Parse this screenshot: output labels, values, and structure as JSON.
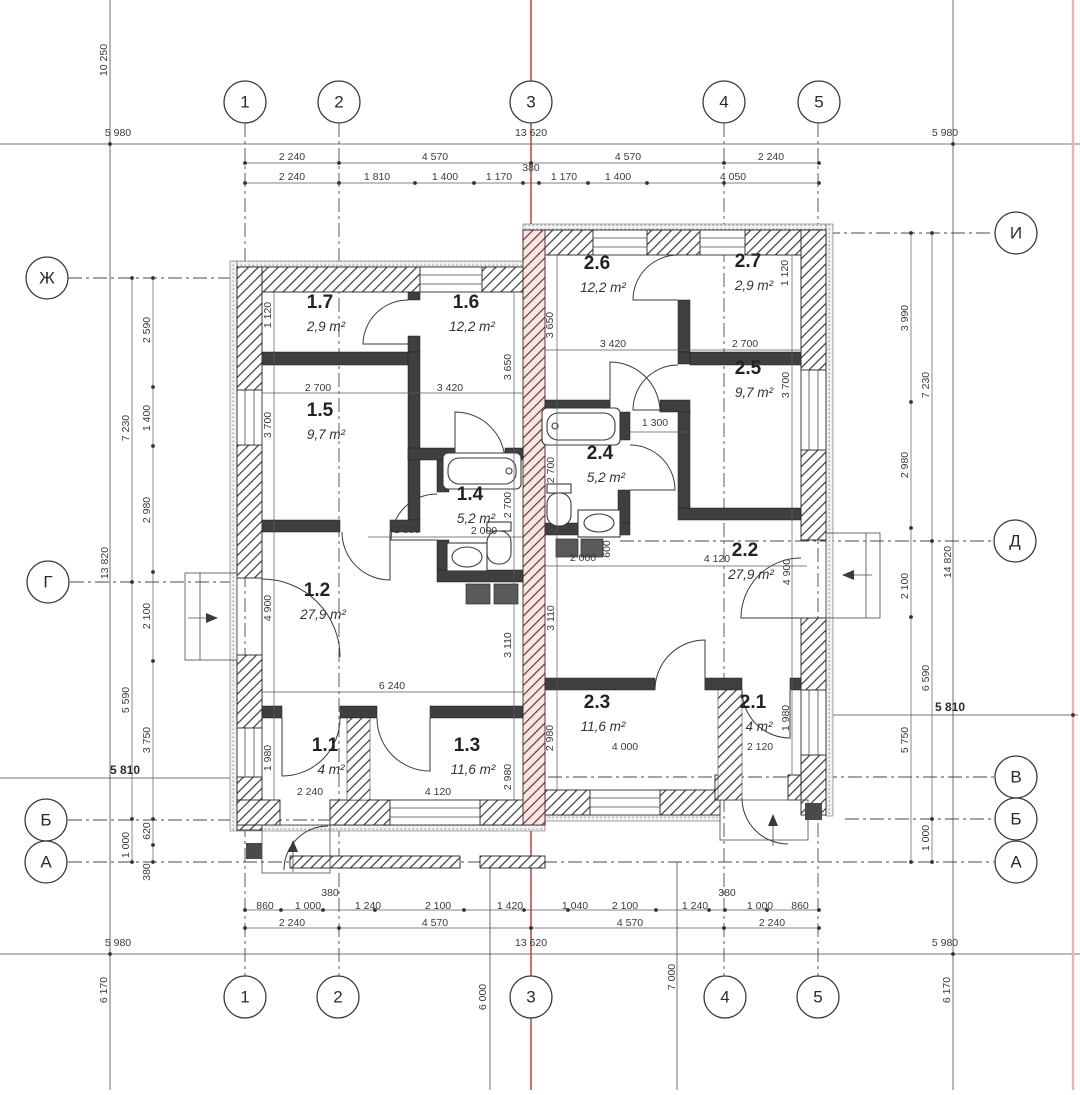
{
  "drawing": {
    "type": "floor-plan",
    "units": "mm",
    "accent_red": "#b5423c",
    "boundary_red": "#e7b6b2",
    "wall_color": "#3f3f3f",
    "party_wall_color": "#6e3531"
  },
  "axes": {
    "top": [
      {
        "label": "1",
        "x": 245,
        "y": 102
      },
      {
        "label": "2",
        "x": 339,
        "y": 102
      },
      {
        "label": "3",
        "x": 531,
        "y": 102
      },
      {
        "label": "4",
        "x": 724,
        "y": 102
      },
      {
        "label": "5",
        "x": 819,
        "y": 102
      }
    ],
    "bottom": [
      {
        "label": "1",
        "x": 245,
        "y": 997
      },
      {
        "label": "2",
        "x": 338,
        "y": 997
      },
      {
        "label": "3",
        "x": 531,
        "y": 997
      },
      {
        "label": "4",
        "x": 725,
        "y": 997
      },
      {
        "label": "5",
        "x": 818,
        "y": 997
      }
    ],
    "left": [
      {
        "label": "Ж",
        "x": 47,
        "y": 278
      },
      {
        "label": "Г",
        "x": 48,
        "y": 582
      },
      {
        "label": "Б",
        "x": 46,
        "y": 820
      },
      {
        "label": "А",
        "x": 46,
        "y": 862
      }
    ],
    "right": [
      {
        "label": "И",
        "x": 1016,
        "y": 233
      },
      {
        "label": "Д",
        "x": 1015,
        "y": 541
      },
      {
        "label": "В",
        "x": 1016,
        "y": 777
      },
      {
        "label": "Б",
        "x": 1016,
        "y": 819
      },
      {
        "label": "А",
        "x": 1016,
        "y": 862
      }
    ]
  },
  "rooms": [
    {
      "number": "1.7",
      "area": "2,9 m²",
      "x": 320,
      "y": 308
    },
    {
      "number": "1.6",
      "area": "12,2 m²",
      "x": 466,
      "y": 308
    },
    {
      "number": "1.5",
      "area": "9,7 m²",
      "x": 320,
      "y": 416
    },
    {
      "number": "1.4",
      "area": "5,2 m²",
      "x": 470,
      "y": 500
    },
    {
      "number": "1.2",
      "area": "27,9 m²",
      "x": 317,
      "y": 596
    },
    {
      "number": "1.1",
      "area": "4 m²",
      "x": 325,
      "y": 751
    },
    {
      "number": "1.3",
      "area": "11,6 m²",
      "x": 467,
      "y": 751
    },
    {
      "number": "2.6",
      "area": "12,2 m²",
      "x": 597,
      "y": 269
    },
    {
      "number": "2.7",
      "area": "2,9 m²",
      "x": 748,
      "y": 267
    },
    {
      "number": "2.5",
      "area": "9,7 m²",
      "x": 748,
      "y": 374
    },
    {
      "number": "2.4",
      "area": "5,2 m²",
      "x": 600,
      "y": 459
    },
    {
      "number": "2.2",
      "area": "27,9 m²",
      "x": 745,
      "y": 556
    },
    {
      "number": "2.3",
      "area": "11,6 m²",
      "x": 597,
      "y": 708
    },
    {
      "number": "2.1",
      "area": "4 m²",
      "x": 753,
      "y": 708
    }
  ],
  "dimensions": [
    {
      "t": "10 250",
      "x": 104,
      "y": 60,
      "r": -90
    },
    {
      "t": "5 980",
      "x": 118,
      "y": 133
    },
    {
      "t": "13 620",
      "x": 531,
      "y": 133
    },
    {
      "t": "5 980",
      "x": 945,
      "y": 133
    },
    {
      "t": "2 240",
      "x": 292,
      "y": 157
    },
    {
      "t": "4 570",
      "x": 435,
      "y": 157
    },
    {
      "t": "4 570",
      "x": 628,
      "y": 157
    },
    {
      "t": "2 240",
      "x": 771,
      "y": 157
    },
    {
      "t": "2 240",
      "x": 292,
      "y": 177
    },
    {
      "t": "1 810",
      "x": 377,
      "y": 177
    },
    {
      "t": "1 400",
      "x": 445,
      "y": 177
    },
    {
      "t": "1 170",
      "x": 499,
      "y": 177
    },
    {
      "t": "380",
      "x": 531,
      "y": 168
    },
    {
      "t": "1 170",
      "x": 564,
      "y": 177
    },
    {
      "t": "1 400",
      "x": 618,
      "y": 177
    },
    {
      "t": "4 050",
      "x": 733,
      "y": 177
    },
    {
      "t": "2 590",
      "x": 147,
      "y": 330,
      "r": -90
    },
    {
      "t": "1 400",
      "x": 147,
      "y": 418,
      "r": -90
    },
    {
      "t": "7 230",
      "x": 126,
      "y": 428,
      "r": -90
    },
    {
      "t": "2 980",
      "x": 147,
      "y": 510,
      "r": -90
    },
    {
      "t": "13 820",
      "x": 105,
      "y": 563,
      "r": -90
    },
    {
      "t": "2 100",
      "x": 147,
      "y": 616,
      "r": -90
    },
    {
      "t": "5 590",
      "x": 126,
      "y": 700,
      "r": -90
    },
    {
      "t": "3 750",
      "x": 147,
      "y": 740,
      "r": -90
    },
    {
      "t": "5 810",
      "x": 125,
      "y": 771,
      "b": 1
    },
    {
      "t": "620",
      "x": 147,
      "y": 831,
      "r": -90
    },
    {
      "t": "1 000",
      "x": 126,
      "y": 845,
      "r": -90
    },
    {
      "t": "380",
      "x": 147,
      "y": 872,
      "r": -90
    },
    {
      "t": "3 990",
      "x": 905,
      "y": 318,
      "r": -90
    },
    {
      "t": "7 230",
      "x": 926,
      "y": 385,
      "r": -90
    },
    {
      "t": "2 980",
      "x": 905,
      "y": 465,
      "r": -90
    },
    {
      "t": "14 820",
      "x": 948,
      "y": 562,
      "r": -90
    },
    {
      "t": "2 100",
      "x": 905,
      "y": 586,
      "r": -90
    },
    {
      "t": "6 590",
      "x": 926,
      "y": 678,
      "r": -90
    },
    {
      "t": "5 810",
      "x": 950,
      "y": 708,
      "b": 1
    },
    {
      "t": "5 750",
      "x": 905,
      "y": 740,
      "r": -90
    },
    {
      "t": "1 000",
      "x": 926,
      "y": 838,
      "r": -90
    },
    {
      "t": "380",
      "x": 330,
      "y": 893
    },
    {
      "t": "860",
      "x": 265,
      "y": 906
    },
    {
      "t": "1 000",
      "x": 308,
      "y": 906
    },
    {
      "t": "1 240",
      "x": 368,
      "y": 906
    },
    {
      "t": "2 100",
      "x": 438,
      "y": 906
    },
    {
      "t": "1 420",
      "x": 510,
      "y": 906
    },
    {
      "t": "1 040",
      "x": 575,
      "y": 906
    },
    {
      "t": "2 100",
      "x": 625,
      "y": 906
    },
    {
      "t": "1 240",
      "x": 695,
      "y": 906
    },
    {
      "t": "380",
      "x": 727,
      "y": 893
    },
    {
      "t": "1 000",
      "x": 760,
      "y": 906
    },
    {
      "t": "860",
      "x": 800,
      "y": 906
    },
    {
      "t": "2 240",
      "x": 292,
      "y": 923
    },
    {
      "t": "4 570",
      "x": 435,
      "y": 923
    },
    {
      "t": "4 570",
      "x": 630,
      "y": 923
    },
    {
      "t": "2 240",
      "x": 772,
      "y": 923
    },
    {
      "t": "5 980",
      "x": 118,
      "y": 943
    },
    {
      "t": "13 620",
      "x": 531,
      "y": 943
    },
    {
      "t": "5 980",
      "x": 945,
      "y": 943
    },
    {
      "t": "6 170",
      "x": 104,
      "y": 990,
      "r": -90
    },
    {
      "t": "6 000",
      "x": 483,
      "y": 997,
      "r": -90
    },
    {
      "t": "7 000",
      "x": 672,
      "y": 977,
      "r": -90
    },
    {
      "t": "6 170",
      "x": 947,
      "y": 990,
      "r": -90
    },
    {
      "t": "1 120",
      "x": 268,
      "y": 315,
      "r": -90
    },
    {
      "t": "2 700",
      "x": 318,
      "y": 388
    },
    {
      "t": "3 420",
      "x": 450,
      "y": 388
    },
    {
      "t": "3 650",
      "x": 508,
      "y": 367,
      "r": -90
    },
    {
      "t": "3 700",
      "x": 268,
      "y": 425,
      "r": -90
    },
    {
      "t": "2 700",
      "x": 508,
      "y": 505,
      "r": -90
    },
    {
      "t": "1 300",
      "x": 407,
      "y": 530
    },
    {
      "t": "2 000",
      "x": 484,
      "y": 531
    },
    {
      "t": "4 900",
      "x": 268,
      "y": 608,
      "r": -90
    },
    {
      "t": "3 110",
      "x": 508,
      "y": 645,
      "r": -90
    },
    {
      "t": "6 240",
      "x": 392,
      "y": 686
    },
    {
      "t": "1 980",
      "x": 268,
      "y": 758,
      "r": -90
    },
    {
      "t": "2 240",
      "x": 310,
      "y": 792
    },
    {
      "t": "4 120",
      "x": 438,
      "y": 792
    },
    {
      "t": "2 980",
      "x": 508,
      "y": 777,
      "r": -90
    },
    {
      "t": "3 650",
      "x": 550,
      "y": 325,
      "r": -90
    },
    {
      "t": "3 420",
      "x": 613,
      "y": 344
    },
    {
      "t": "2 700",
      "x": 745,
      "y": 344
    },
    {
      "t": "1 120",
      "x": 785,
      "y": 273,
      "r": -90
    },
    {
      "t": "3 700",
      "x": 786,
      "y": 385,
      "r": -90
    },
    {
      "t": "2 700",
      "x": 551,
      "y": 470,
      "r": -90
    },
    {
      "t": "1 300",
      "x": 655,
      "y": 423
    },
    {
      "t": "2 000",
      "x": 583,
      "y": 558
    },
    {
      "t": "600",
      "x": 607,
      "y": 549,
      "r": -90
    },
    {
      "t": "4 120",
      "x": 717,
      "y": 559
    },
    {
      "t": "4 900",
      "x": 787,
      "y": 572,
      "r": -90
    },
    {
      "t": "3 110",
      "x": 551,
      "y": 618,
      "r": -90
    },
    {
      "t": "2 980",
      "x": 550,
      "y": 738,
      "r": -90
    },
    {
      "t": "4 000",
      "x": 625,
      "y": 747
    },
    {
      "t": "2 120",
      "x": 760,
      "y": 747
    },
    {
      "t": "1 980",
      "x": 786,
      "y": 718,
      "r": -90
    }
  ]
}
